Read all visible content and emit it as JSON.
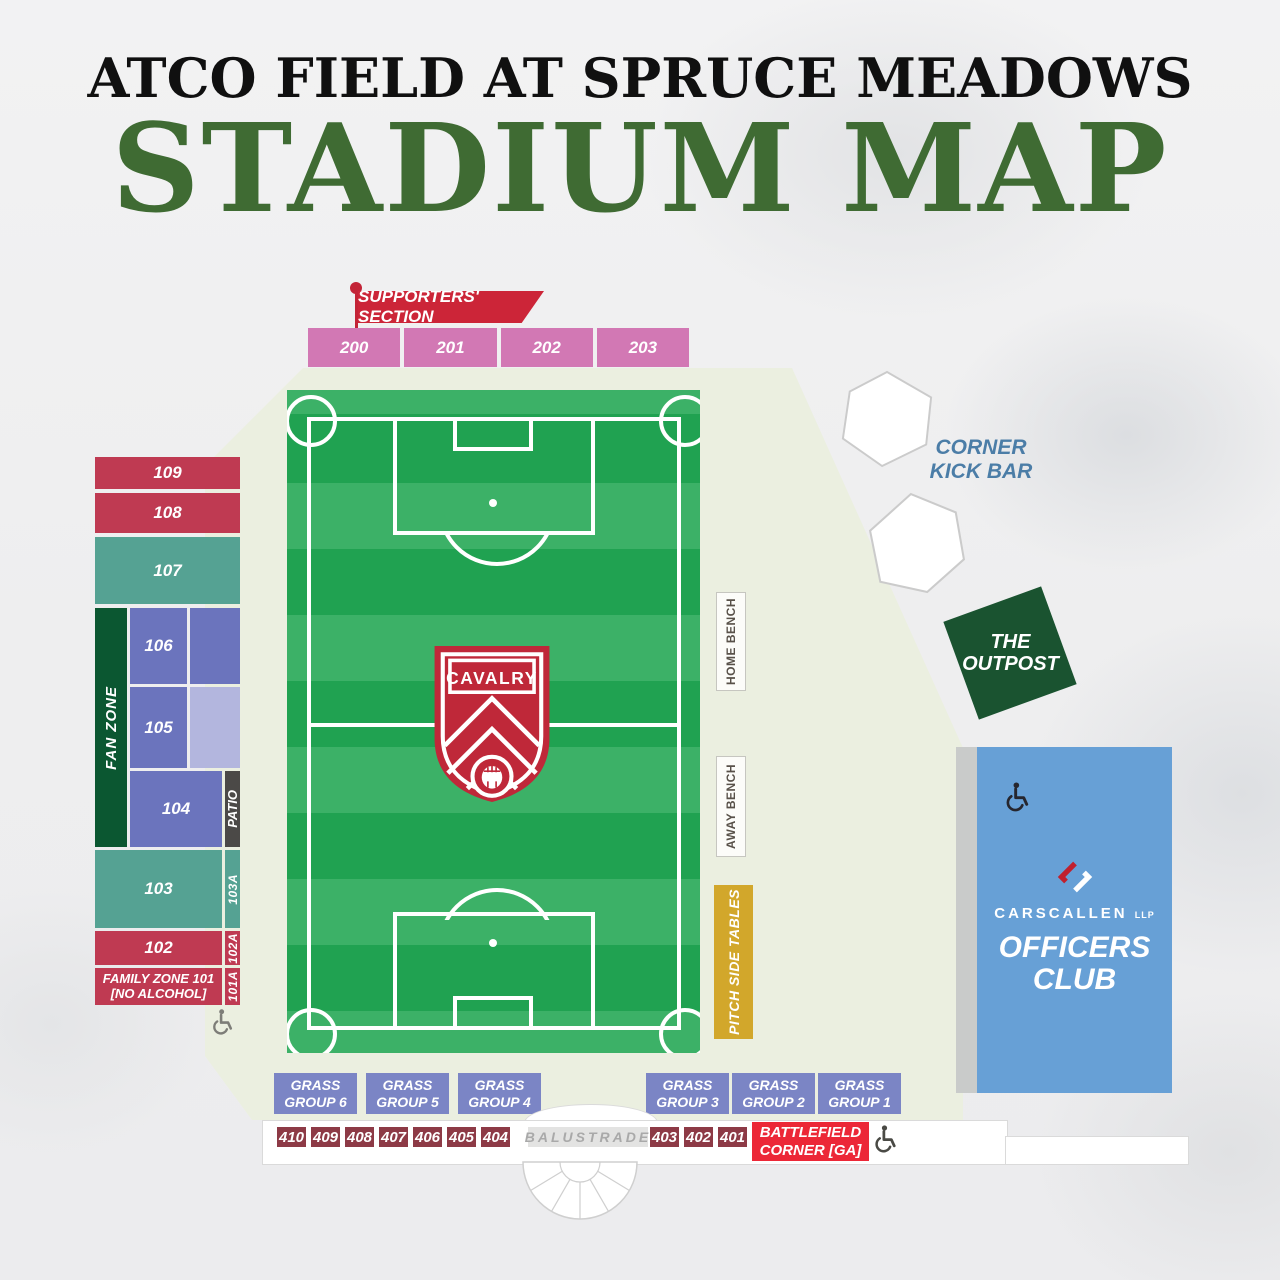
{
  "title": {
    "venue": "ATCO FIELD AT SPRUCE MEADOWS",
    "heading": "STADIUM MAP"
  },
  "colors": {
    "heading_green": "#3f6b33",
    "section_red": "#bf3a52",
    "section_teal": "#55a293",
    "section_purple": "#6b74bd",
    "section_purple_light": "#b3b6de",
    "supporters_pink": "#d278b4",
    "fan_zone_green": "#0b5731",
    "patio_gray": "#4b4947",
    "pitch_green": "#20a251",
    "pitch_stripe": "#3cb167",
    "crest_red": "#bf2839",
    "tables_gold": "#d2a72b",
    "officers_blue": "#67a0d6",
    "grass_purple": "#7b85c5",
    "south_maroon": "#8d3a46",
    "battlefield_red": "#ec2737",
    "flag_red": "#cc2538",
    "kickbar_blue": "#4b7da7",
    "outpost_green": "#1a5330"
  },
  "supporters": {
    "banner": "SUPPORTERS' SECTION",
    "sections": [
      "200",
      "201",
      "202",
      "203"
    ]
  },
  "west_stand": {
    "fan_zone": "FAN ZONE",
    "patio": "PATIO",
    "rows": {
      "s109": "109",
      "s108": "108",
      "s107": "107",
      "s106": "106",
      "s105": "105",
      "s104": "104",
      "s103": "103",
      "s102": "102",
      "family": "FAMILY ZONE 101\n[NO ALCOHOL]",
      "s103a": "103A",
      "s102a": "102A",
      "s101a": "101A"
    }
  },
  "pitch": {
    "crest": "CAVALRY"
  },
  "east_side": {
    "home_bench": "HOME BENCH",
    "away_bench": "AWAY BENCH",
    "pitch_side_tables": "PITCH SIDE TABLES"
  },
  "venues": {
    "corner_kick_bar": "CORNER\nKICK BAR",
    "outpost": "THE\nOUTPOST",
    "officers_club": {
      "sponsor": "CARSCALLEN",
      "sponsor_suffix": "LLP",
      "name": "OFFICERS\nCLUB"
    }
  },
  "grass_groups": [
    "GRASS\nGROUP 6",
    "GRASS\nGROUP 5",
    "GRASS\nGROUP 4",
    "GRASS\nGROUP 3",
    "GRASS\nGROUP 2",
    "GRASS\nGROUP 1"
  ],
  "south_row": {
    "sections_west": [
      "410",
      "409",
      "408",
      "407",
      "406",
      "405",
      "404"
    ],
    "balustrade": "BALUSTRADE",
    "sections_east": [
      "403",
      "402",
      "401"
    ],
    "battlefield": "BATTLEFIELD\nCORNER [GA]"
  }
}
